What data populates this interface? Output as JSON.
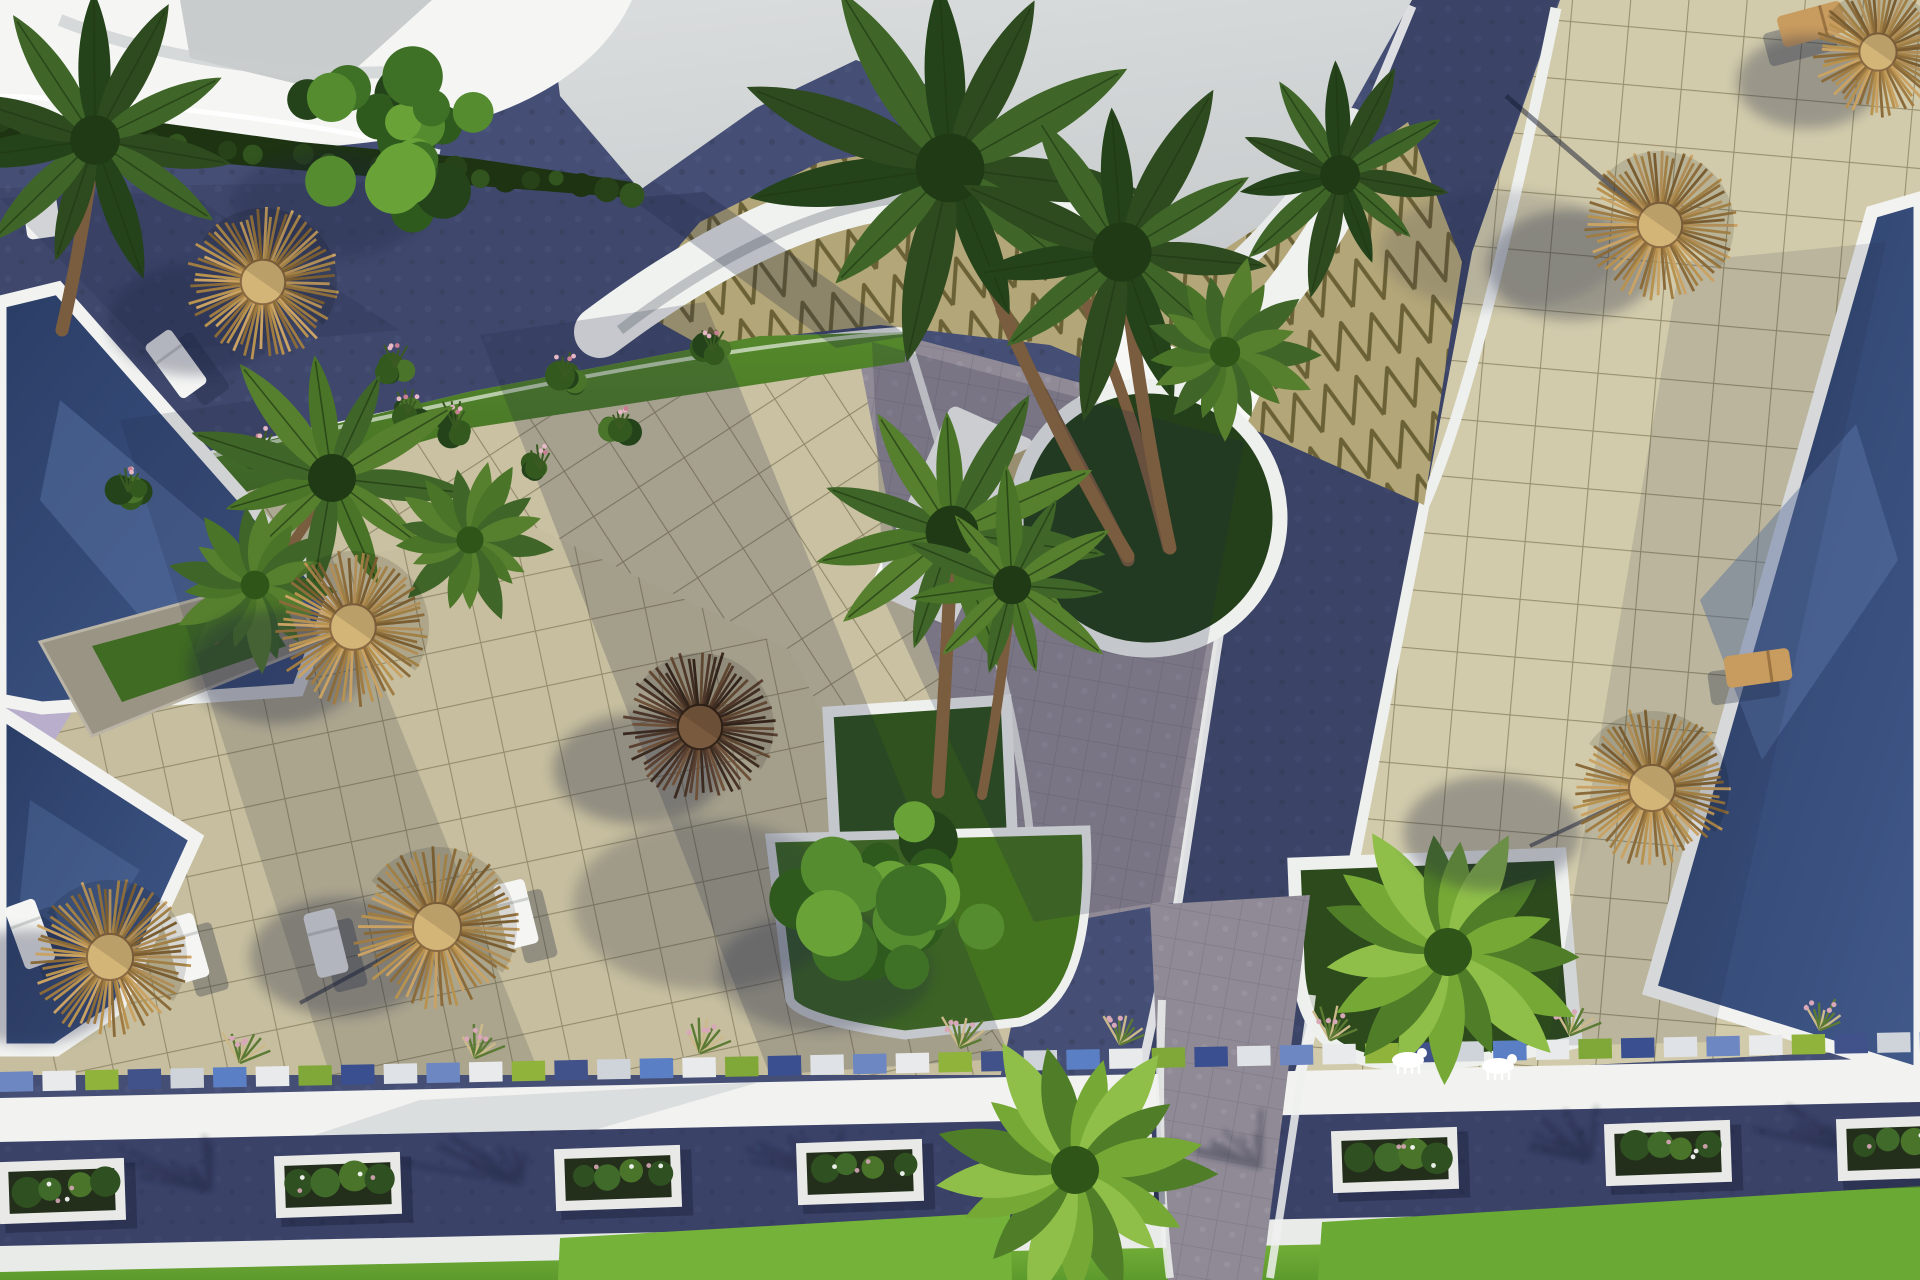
{
  "scene": {
    "canvas": {
      "width": 1920,
      "height": 1280
    },
    "description": "aerial-3d-render-resort-courtyard",
    "palette": {
      "sky": "#d7dadb",
      "sky2": "#c9cdcf",
      "sail": "#f5f6f4",
      "terrace": "#cdc5a4",
      "terrace_right": "#d2cbab",
      "tile_line": "#847c58",
      "road": "#454e74",
      "road_dark": "#3a4263",
      "plaza": "#908a96",
      "pool_dark": "#273a63",
      "pool_mid": "#3e5586",
      "pool_light": "#5d77a8",
      "curb": "#eef0ee",
      "white_wall": "#f2f3f0",
      "lawn": "#4a7a24",
      "lawn_bright": "#6fae35",
      "lawn_dark": "#2c4a1c",
      "hedge": "#1d3312",
      "straw1": "#caa263",
      "straw2": "#b8924f",
      "straw3": "#a07c42",
      "straw4": "#8a6a38",
      "straw_hub": "#d4b578",
      "dark1": "#6e5138",
      "dark2": "#5a4030",
      "dark3": "#4a3528",
      "dark4": "#3b2a1f",
      "dark_hub": "#7a5a3e",
      "trunk": "#7a5c3e",
      "frond_dark": "#2e4a1f",
      "frond_mid": "#3f6628",
      "frond_light": "#567f2e",
      "fan1": "#4f7d28",
      "fan2": "#76a836",
      "fan3": "#8fbf49",
      "fan_core": "#2f5519",
      "tri_tan": "#b3a678",
      "tri_line": "#6b6136",
      "stone": "#9a9484",
      "lilac": "#b9aecb",
      "flower": "#d8a7b8",
      "soil": "#232e1b",
      "shadow": "#1c2440"
    },
    "umbrellas": [
      {
        "x": 263,
        "y": 282,
        "r": 74,
        "style": "straw",
        "sdx": -70,
        "sdy": 38
      },
      {
        "x": 353,
        "y": 627,
        "r": 76,
        "style": "straw",
        "sdx": -78,
        "sdy": 40
      },
      {
        "x": 700,
        "y": 727,
        "r": 74,
        "style": "dark",
        "sdx": -62,
        "sdy": 42
      },
      {
        "x": 437,
        "y": 927,
        "r": 80,
        "style": "straw",
        "sdx": -95,
        "sdy": 30
      },
      {
        "x": 110,
        "y": 957,
        "r": 77,
        "style": "straw",
        "sdx": -80,
        "sdy": 30
      },
      {
        "x": 1660,
        "y": 225,
        "r": 74,
        "style": "straw",
        "sdx": -88,
        "sdy": 40
      },
      {
        "x": 1652,
        "y": 788,
        "r": 77,
        "style": "straw",
        "sdx": -160,
        "sdy": 45
      },
      {
        "x": 1878,
        "y": 52,
        "r": 62,
        "style": "straw",
        "sdx": -70,
        "sdy": 30
      }
    ],
    "loungers": [
      {
        "x": 30,
        "y": 934,
        "rot": -20,
        "style": "white"
      },
      {
        "x": 186,
        "y": 948,
        "rot": -16,
        "style": "white"
      },
      {
        "x": 326,
        "y": 943,
        "rot": -14,
        "style": "white"
      },
      {
        "x": 516,
        "y": 914,
        "rot": -14,
        "style": "white"
      },
      {
        "x": 176,
        "y": 364,
        "rot": -36,
        "style": "white"
      },
      {
        "x": 1758,
        "y": 668,
        "rot": 82,
        "style": "wood"
      },
      {
        "x": 1812,
        "y": 24,
        "rot": 75,
        "style": "wood"
      }
    ],
    "palms": [
      {
        "x": 950,
        "y": 168,
        "r": 215,
        "type": "palm",
        "shade": "dark",
        "trunk": [
          1128,
          556
        ]
      },
      {
        "x": 1122,
        "y": 252,
        "r": 185,
        "type": "palm",
        "shade": "dark",
        "trunk": [
          1170,
          548
        ]
      },
      {
        "x": 952,
        "y": 532,
        "r": 165,
        "type": "palm",
        "shade": "mid",
        "trunk": [
          938,
          792
        ]
      },
      {
        "x": 1012,
        "y": 585,
        "r": 120,
        "type": "palm",
        "shade": "mid",
        "trunk": [
          982,
          795
        ]
      },
      {
        "x": 332,
        "y": 478,
        "r": 150,
        "type": "palm",
        "shade": "mid",
        "trunk": [
          214,
          640
        ]
      },
      {
        "x": 95,
        "y": 140,
        "r": 155,
        "type": "palm",
        "shade": "dark",
        "trunk": [
          62,
          330
        ]
      },
      {
        "x": 1340,
        "y": 175,
        "r": 125,
        "type": "palm",
        "shade": "dark"
      },
      {
        "x": 255,
        "y": 585,
        "r": 90,
        "type": "fan",
        "shade": "mid"
      },
      {
        "x": 470,
        "y": 540,
        "r": 85,
        "type": "fan",
        "shade": "mid"
      },
      {
        "x": 1225,
        "y": 352,
        "r": 95,
        "type": "fan",
        "shade": "mid"
      },
      {
        "x": 1448,
        "y": 952,
        "r": 150,
        "type": "fan",
        "shade": "light"
      },
      {
        "x": 1075,
        "y": 1170,
        "r": 150,
        "type": "fan",
        "shade": "light"
      }
    ],
    "trees": [
      {
        "x": 382,
        "y": 146,
        "r": 108
      },
      {
        "x": 884,
        "y": 906,
        "r": 120
      }
    ],
    "shrubs": [
      {
        "x": 128,
        "y": 492
      },
      {
        "x": 262,
        "y": 452
      },
      {
        "x": 408,
        "y": 415
      },
      {
        "x": 565,
        "y": 378
      },
      {
        "x": 712,
        "y": 352
      },
      {
        "x": 395,
        "y": 368
      },
      {
        "x": 455,
        "y": 428
      },
      {
        "x": 540,
        "y": 470
      },
      {
        "x": 620,
        "y": 430
      }
    ],
    "road_planters": [
      {
        "x": 62,
        "y": 1191
      },
      {
        "x": 338,
        "y": 1185
      },
      {
        "x": 618,
        "y": 1178
      },
      {
        "x": 860,
        "y": 1172
      },
      {
        "x": 1090,
        "y": 1167
      },
      {
        "x": 1395,
        "y": 1160
      },
      {
        "x": 1668,
        "y": 1153
      },
      {
        "x": 1900,
        "y": 1148
      }
    ],
    "road_tree_shadows": [
      210,
      520,
      830,
      1260,
      1590,
      1860
    ],
    "strip": {
      "x0": 0,
      "y0": 1092,
      "x1": 1920,
      "y1": 1052,
      "count": 46,
      "h": 20,
      "colors": [
        "#6d87c2",
        "#e8eaec",
        "#8fb33b",
        "#41518a",
        "#cfd3da",
        "#5b7fc4",
        "#e8eaec",
        "#7fa838",
        "#3a4f8f",
        "#dfe2e6"
      ]
    },
    "grass_clumps": [
      {
        "x": 240
      },
      {
        "x": 475
      },
      {
        "x": 700
      },
      {
        "x": 960
      },
      {
        "x": 1120
      },
      {
        "x": 1330
      },
      {
        "x": 1570
      },
      {
        "x": 1820
      }
    ],
    "statues": [
      {
        "x": 1408,
        "y": 1060
      },
      {
        "x": 1498,
        "y": 1066
      }
    ],
    "hedge_bumps": {
      "count": 26,
      "x0": 0,
      "y0": 120,
      "x1": 632,
      "y1": 186
    }
  }
}
